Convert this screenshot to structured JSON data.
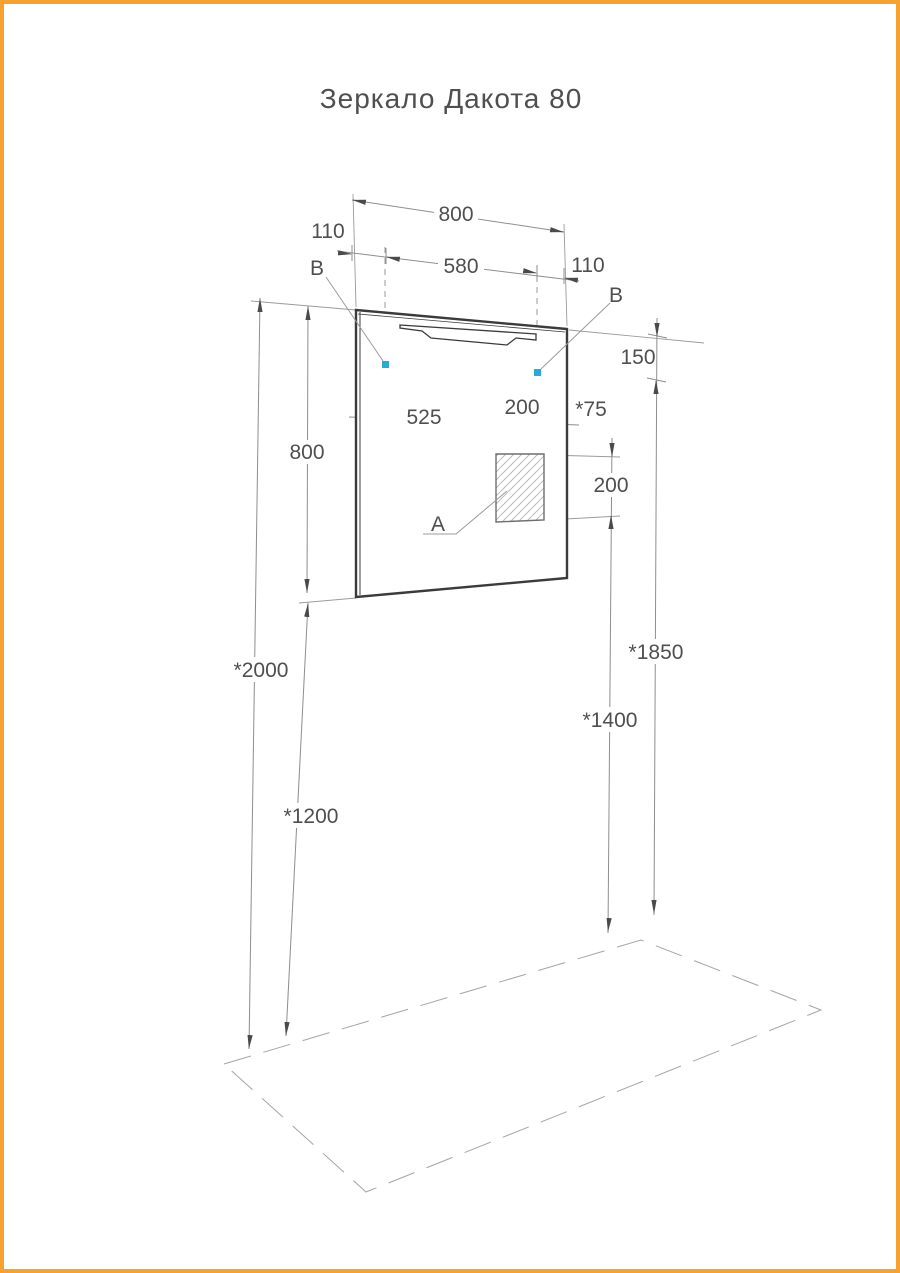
{
  "title": "Зеркало Дакота 80",
  "drawing": {
    "labels": {
      "socket": "A",
      "mount_left": "B",
      "mount_right": "B"
    },
    "dims": {
      "total_width": "800",
      "left_offset": "110",
      "mount_span": "580",
      "right_offset": "110",
      "mirror_height": "800",
      "lamp_offset": "150",
      "socket_from_left": "525",
      "socket_width": "200",
      "socket_to_edge": "*75",
      "socket_height": "200",
      "top_height": "*2000",
      "bottom_height": "*1200",
      "socket_top_height": "*1850",
      "socket_bottom_height": "*1400"
    },
    "colors": {
      "accent": "#2BA9D6",
      "page_border": "#F7A12E"
    }
  }
}
